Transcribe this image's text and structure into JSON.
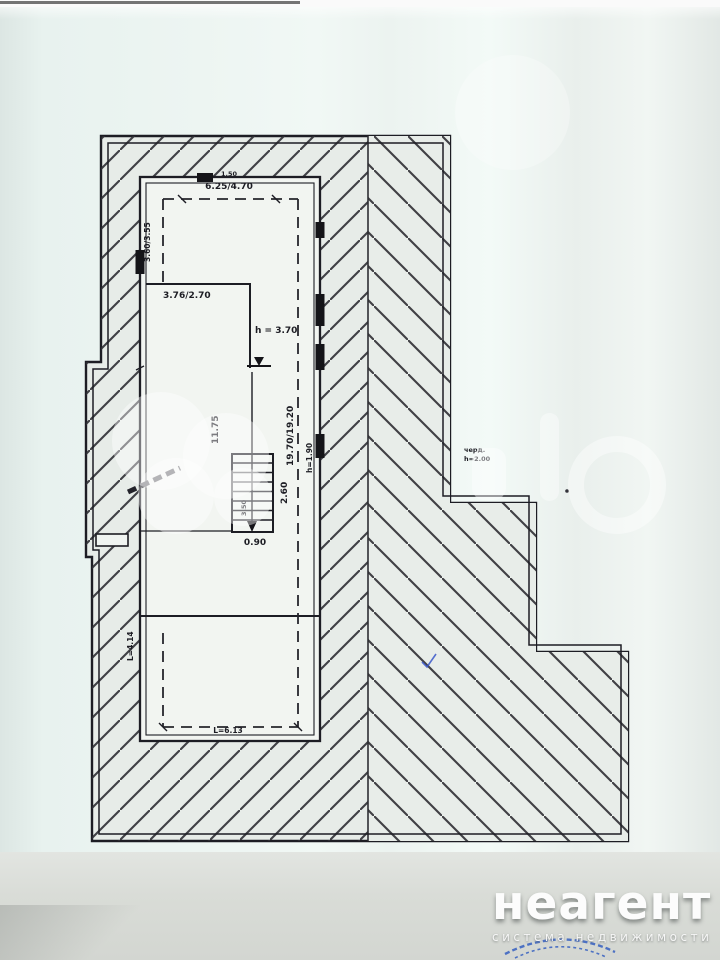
{
  "plan": {
    "labels": {
      "top_small": "1.50",
      "top_width": "6.25/4.70",
      "left_height": "3.60/3.55",
      "room_upper_left": "3.76/2.70",
      "ceiling_main": "h = 3.70",
      "length_left": "11.75",
      "length_right": "19.70/19.20",
      "ceiling_low": "h=1.90",
      "stairs_depth": "2.60",
      "stairs_flight": "3.50",
      "stairs_width": "0.90",
      "lower_room_width": "L=6.13",
      "lower_room_height": "L=4.14",
      "attic_line1": "черд.",
      "attic_line2": "h=2.00"
    },
    "symbols": [
      "elevation-mark",
      "stairs-down-arrow",
      "roof-ridge",
      "hatching"
    ],
    "colors": {
      "ink": "#1d1d24",
      "paper": "#edf3f0",
      "room_fill": "#f2f5f1",
      "stamp_blue": "#2b58c0"
    }
  },
  "watermark": {
    "brand": "неагент",
    "tagline": "система недвижимости",
    "ghost_letters": "to"
  }
}
